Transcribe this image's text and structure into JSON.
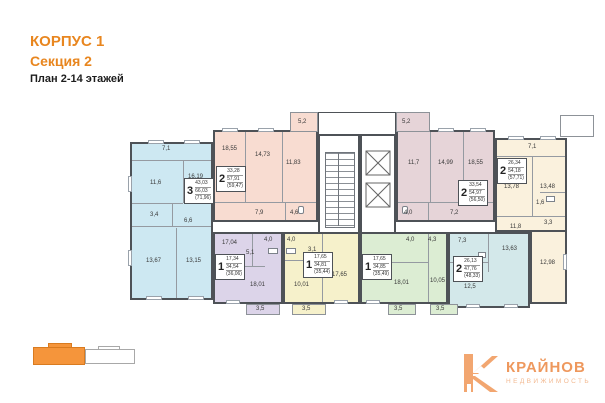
{
  "header": {
    "korpus": "КОРПУС 1",
    "section": "Секция 2",
    "plan_label": "План 2-14 этажей"
  },
  "colors": {
    "accent_orange": "#e8861f",
    "apartment_3room_blue": "#cde8f2",
    "apartment_2room_pink": "#f8dcd1",
    "apartment_2room_mauve": "#e6d4d8",
    "apartment_2room_cream": "#faf1dd",
    "apartment_1room_purple": "#dcd4e9",
    "apartment_1room_yellow": "#f6f1cb",
    "apartment_1room_green": "#dcedd3",
    "apartment_2room_blue": "#d3e8ea",
    "minimap_highlight": "#f5953b"
  },
  "apartments": [
    {
      "key": "blue-3room",
      "rooms_count": "3",
      "living": "43,03",
      "total": "66,03",
      "with_balconies": "(71,96)",
      "rooms": [
        "7,1",
        "11,6",
        "16,19",
        "3,4",
        "6,6",
        "13,67",
        "13,15"
      ]
    },
    {
      "key": "pink-2room",
      "rooms_count": "2",
      "living": "33,28",
      "total": "57,91",
      "with_balconies": "(59,47)",
      "rooms": [
        "5,2",
        "18,55",
        "14,73",
        "11,83",
        "7,9",
        "4,6"
      ]
    },
    {
      "key": "mauve-2room",
      "rooms_count": "2",
      "living": "33,54",
      "total": "54,97",
      "with_balconies": "(56,50)",
      "rooms": [
        "5,2",
        "11,7",
        "14,99",
        "18,55",
        "4,0",
        "7,2"
      ]
    },
    {
      "key": "cream-2room",
      "rooms_count": "2",
      "living": "26,34",
      "total": "54,18",
      "with_balconies": "(57,71)",
      "rooms": [
        "7,1",
        "13,78",
        "13,48",
        "1,6",
        "3,3",
        "11,8",
        "12,98"
      ]
    },
    {
      "key": "purple-1room",
      "rooms_count": "1",
      "living": "17,34",
      "total": "34,54",
      "with_balconies": "(36,06)",
      "rooms": [
        "17,04",
        "4,0",
        "5,1",
        "18,01",
        "3,5"
      ]
    },
    {
      "key": "yellow-1room",
      "rooms_count": "1",
      "living": "17,65",
      "total": "34,81",
      "with_balconies": "(35,44)",
      "rooms": [
        "4,0",
        "3,1",
        "10,01",
        "17,65",
        "3,5"
      ]
    },
    {
      "key": "green-1room",
      "rooms_count": "1",
      "living": "17,65",
      "total": "34,85",
      "with_balconies": "(35,49)",
      "rooms": [
        "4,0",
        "4,3",
        "18,01",
        "10,05",
        "3,5"
      ]
    },
    {
      "key": "blue-2room",
      "rooms_count": "2",
      "living": "26,13",
      "total": "47,76",
      "with_balconies": "(48,33)",
      "rooms": [
        "7,3",
        "13,63",
        "12,5",
        "3,5"
      ]
    }
  ],
  "logo": {
    "mark": "К",
    "title": "КРАЙНОВ",
    "subtitle": "НЕДВИЖИМОСТЬ"
  }
}
